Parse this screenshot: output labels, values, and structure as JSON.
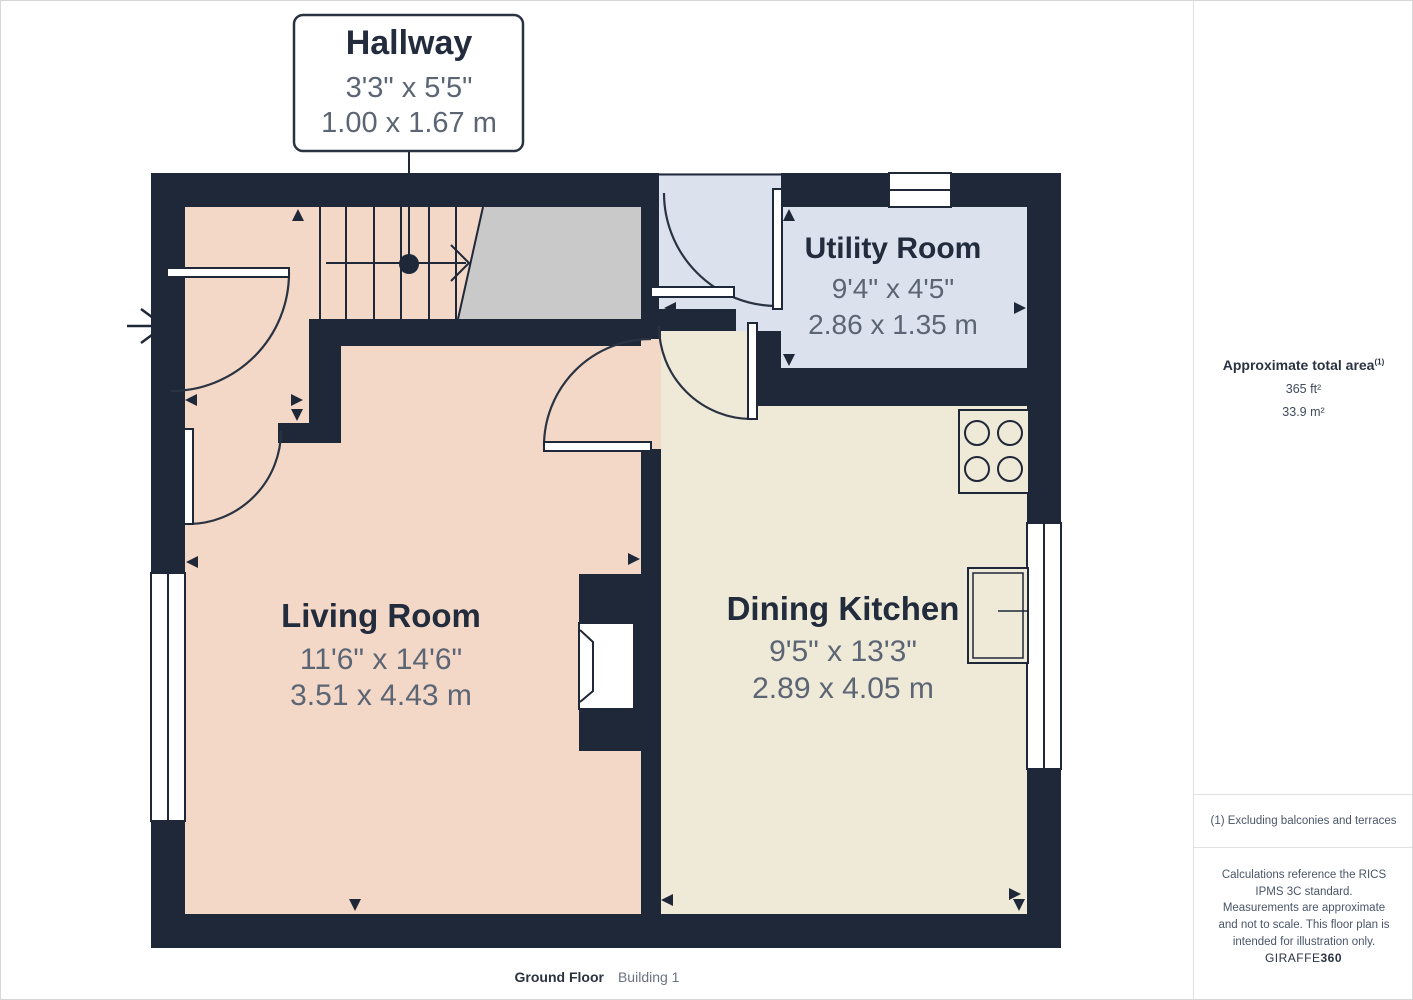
{
  "plan": {
    "callout": {
      "room": "Hallway",
      "imperial": "3'3\" x 5'5\"",
      "metric": "1.00 x 1.67 m"
    },
    "rooms": {
      "utility": {
        "name": "Utility Room",
        "imperial": "9'4\" x 4'5\"",
        "metric": "2.86 x 1.35 m"
      },
      "living": {
        "name": "Living Room",
        "imperial": "11'6\" x 14'6\"",
        "metric": "3.51 x 4.43 m"
      },
      "kitchen": {
        "name": "Dining Kitchen",
        "imperial": "9'5\" x 13'3\"",
        "metric": "2.89 x 4.05 m"
      }
    },
    "colors": {
      "wall": "#1f2838",
      "living_floor": "#f3d8c8",
      "kitchen_floor": "#efe9d8",
      "utility_floor": "#dce1ee",
      "landing_floor": "#c9c9c9",
      "dim_text": "#5c6574",
      "name_text": "#222c3d"
    }
  },
  "footer": {
    "floor": "Ground Floor",
    "building": "Building 1"
  },
  "sidebar": {
    "area_title": "Approximate total area",
    "area_footnote_marker": "(1)",
    "area_ft": "365 ft²",
    "area_m": "33.9 m²",
    "footnote": "(1) Excluding balconies and terraces",
    "disclaimer": "Calculations reference the RICS IPMS 3C standard. Measurements are approximate and not to scale. This floor plan is intended for illustration only.",
    "brand": "GIRAFFE",
    "brand_suffix": "360"
  }
}
